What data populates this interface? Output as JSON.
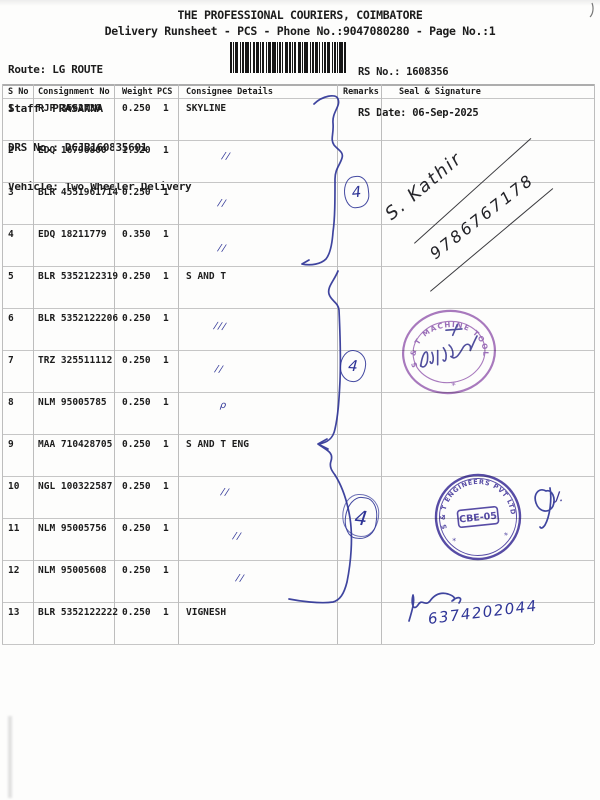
{
  "page": {
    "title": "THE PROFESSIONAL COURIERS, COIMBATORE",
    "subtitle": "Delivery Runsheet - PCS - Phone No.:9047080280 - Page No.:1"
  },
  "meta": {
    "route": "Route: LG ROUTE",
    "staff": "Staff: PRASANNA",
    "drs_no": "DRS No.: DCJB160835601",
    "vehicle": "Vehicle: Two Wheeler Delivery",
    "rs_no": "RS No.: 1608356",
    "rs_date": "RS Date: 06-Sep-2025"
  },
  "table": {
    "columns": [
      "S No",
      "Consignment No",
      "Weight",
      "PCS",
      "Consignee Details",
      "Remarks",
      "Seal & Signature"
    ],
    "rows": [
      {
        "sno": "1",
        "consignment": "RJP 3662730",
        "weight": "0.250",
        "pcs": "1",
        "consignee": "SKYLINE",
        "ditto": ""
      },
      {
        "sno": "2",
        "consignment": "EDQ 16796800",
        "weight": "1.320",
        "pcs": "1",
        "consignee": "",
        "ditto": "//"
      },
      {
        "sno": "3",
        "consignment": "BLR 4551961714",
        "weight": "0.250",
        "pcs": "1",
        "consignee": "",
        "ditto": "//"
      },
      {
        "sno": "4",
        "consignment": "EDQ 18211779",
        "weight": "0.350",
        "pcs": "1",
        "consignee": "",
        "ditto": "//"
      },
      {
        "sno": "5",
        "consignment": "BLR 5352122319",
        "weight": "0.250",
        "pcs": "1",
        "consignee": "S AND T",
        "ditto": ""
      },
      {
        "sno": "6",
        "consignment": "BLR 5352122206",
        "weight": "0.250",
        "pcs": "1",
        "consignee": "",
        "ditto": "///"
      },
      {
        "sno": "7",
        "consignment": "TRZ 325511112",
        "weight": "0.250",
        "pcs": "1",
        "consignee": "",
        "ditto": "//"
      },
      {
        "sno": "8",
        "consignment": "NLM 95005785",
        "weight": "0.250",
        "pcs": "1",
        "consignee": "",
        "ditto": "ρ"
      },
      {
        "sno": "9",
        "consignment": "MAA 710428705",
        "weight": "0.250",
        "pcs": "1",
        "consignee": "S AND T ENG",
        "ditto": ""
      },
      {
        "sno": "10",
        "consignment": "NGL 100322587",
        "weight": "0.250",
        "pcs": "1",
        "consignee": "",
        "ditto": "//"
      },
      {
        "sno": "11",
        "consignment": "NLM 95005756",
        "weight": "0.250",
        "pcs": "1",
        "consignee": "",
        "ditto": "//"
      },
      {
        "sno": "12",
        "consignment": "NLM 95005608",
        "weight": "0.250",
        "pcs": "1",
        "consignee": "",
        "ditto": "//"
      },
      {
        "sno": "13",
        "consignment": "BLR 5352122222",
        "weight": "0.250",
        "pcs": "1",
        "consignee": "VIGNESH",
        "ditto": ""
      }
    ]
  },
  "annotations": {
    "circled_numbers": [
      "4",
      "4",
      "4"
    ],
    "signature_name": "S. Kathir",
    "signature_phone": "9786767178",
    "bottom_phone": "6374202044",
    "initials": "J.",
    "pen_color": "#2f3597",
    "ink_black": "#2a2a2a"
  },
  "stamps": {
    "oval": {
      "ring_text": "S & T MACHINE TOOLS",
      "bottom_mark": "*",
      "color": "#9a63b5"
    },
    "round": {
      "ring_text": "S & T ENGINEERS PVT LTD",
      "center": "CBE-05",
      "side_marks": [
        "*",
        "*"
      ],
      "color": "#46399e"
    }
  }
}
